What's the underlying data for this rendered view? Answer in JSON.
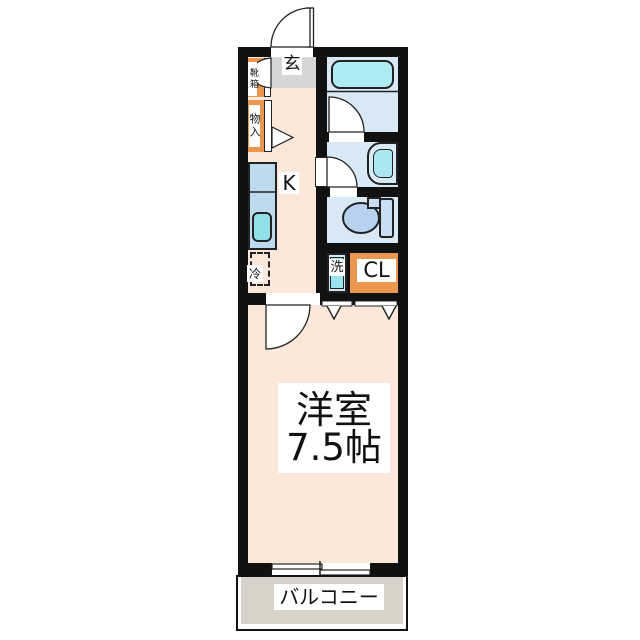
{
  "plan": {
    "type": "apartment-floor-plan",
    "labels": {
      "entrance": "玄",
      "shoe_box": "靴箱",
      "storage": "物入",
      "kitchen": "K",
      "refrigerator": "冷",
      "washer": "洗",
      "closet": "CL",
      "room_name": "洋室",
      "room_size": "7.5帖",
      "balcony": "バルコニー"
    },
    "colors": {
      "wall": "#111111",
      "floor_peach": "#fce8da",
      "entrance_gray": "#d6d6d6",
      "cabinet_orange": "#eb9750",
      "wet_room_blue": "#d9e8f5",
      "bathtub_cyan": "#aeebf2",
      "counter_blue": "#bedbee",
      "sink_cyan": "#90dfe9",
      "toilet_blue": "#b7d1ee",
      "tank_blue": "#c9def2",
      "balcony_gray": "#d8d2c8"
    }
  }
}
